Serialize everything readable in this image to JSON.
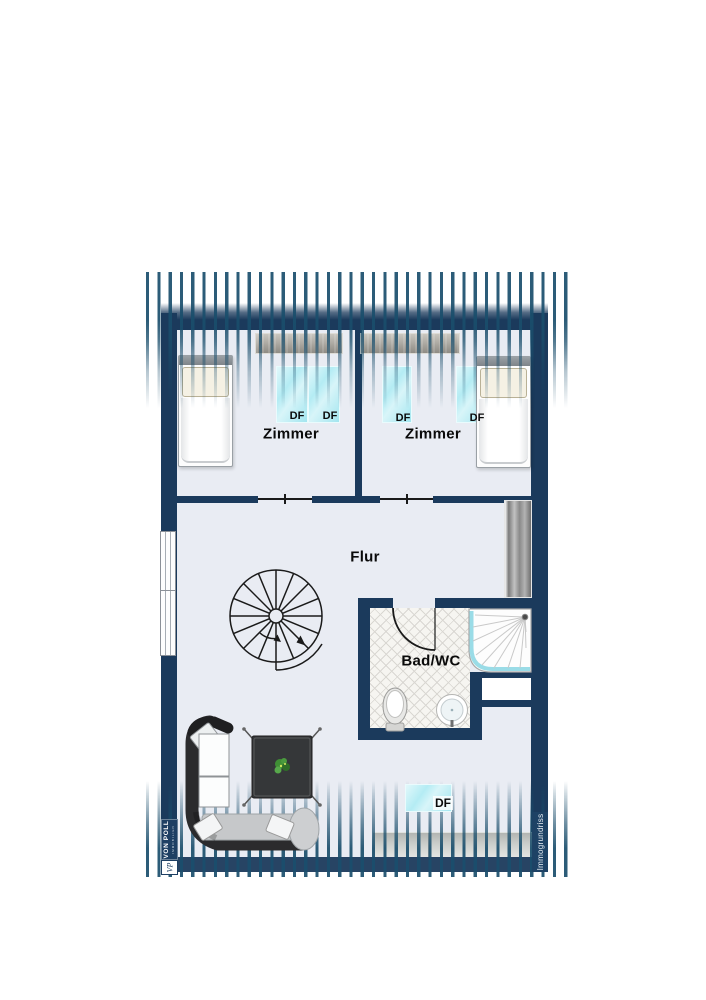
{
  "document": {
    "type": "floor-plan",
    "language": "de"
  },
  "rooms": [
    {
      "label": "Zimmer"
    },
    {
      "label": "Zimmer"
    },
    {
      "label": "Flur"
    },
    {
      "label": "Bad/WC"
    }
  ],
  "skylights": [
    {
      "label": "DF"
    },
    {
      "label": "DF"
    },
    {
      "label": "DF"
    },
    {
      "label": "DF"
    },
    {
      "label": "DF"
    }
  ],
  "branding": {
    "agency_name": "VON POLL",
    "agency_subtitle": "IMMOBILIEN",
    "agency_monogram": "VP",
    "watermark": "Immogrundriss"
  },
  "colors": {
    "wall": "#1b3a5c",
    "roof_hatch": "#1a4e6c",
    "floor": "#e9ecf3",
    "skylight": "#b4ecf4",
    "badge": "#1e3f63"
  }
}
